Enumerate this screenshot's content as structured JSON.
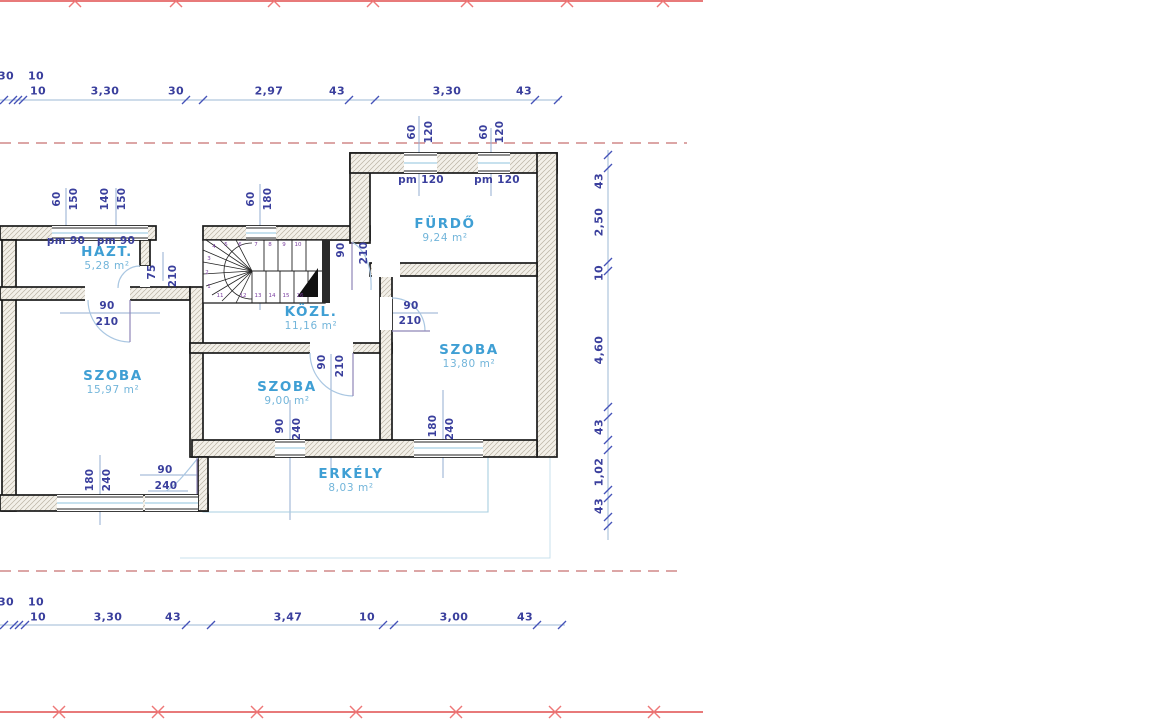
{
  "plan": {
    "rooms": [
      {
        "name": "HÁZT.",
        "area": "5,28 m²",
        "x": 107,
        "y": 252
      },
      {
        "name": "FÜRDŐ",
        "area": "9,24 m²",
        "x": 445,
        "y": 224
      },
      {
        "name": "KÖZL.",
        "area": "11,16 m²",
        "x": 311,
        "y": 312
      },
      {
        "name": "SZOBA",
        "area": "15,97 m²",
        "x": 113,
        "y": 376
      },
      {
        "name": "SZOBA",
        "area": "9,00 m²",
        "x": 287,
        "y": 387
      },
      {
        "name": "SZOBA",
        "area": "13,80 m²",
        "x": 469,
        "y": 350
      },
      {
        "name": "ERKÉLY",
        "area": "8,03 m²",
        "x": 351,
        "y": 474
      }
    ],
    "dim_rows": {
      "top_stacked": [
        {
          "t": "30",
          "x": 6,
          "y": 76
        },
        {
          "t": "10",
          "x": 36,
          "y": 76
        }
      ],
      "top": [
        {
          "t": "10",
          "x": 38,
          "y": 91
        },
        {
          "t": "3,30",
          "x": 105,
          "y": 91
        },
        {
          "t": "30",
          "x": 176,
          "y": 91
        },
        {
          "t": "2,97",
          "x": 269,
          "y": 91
        },
        {
          "t": "43",
          "x": 337,
          "y": 91
        },
        {
          "t": "3,30",
          "x": 447,
          "y": 91
        },
        {
          "t": "43",
          "x": 524,
          "y": 91
        }
      ],
      "bottom_stacked": [
        {
          "t": "30",
          "x": 6,
          "y": 602
        },
        {
          "t": "10",
          "x": 36,
          "y": 602
        }
      ],
      "bottom": [
        {
          "t": "10",
          "x": 38,
          "y": 617
        },
        {
          "t": "3,30",
          "x": 108,
          "y": 617
        },
        {
          "t": "43",
          "x": 173,
          "y": 617
        },
        {
          "t": "3,47",
          "x": 288,
          "y": 617
        },
        {
          "t": "10",
          "x": 367,
          "y": 617
        },
        {
          "t": "3,00",
          "x": 454,
          "y": 617
        },
        {
          "t": "43",
          "x": 525,
          "y": 617
        }
      ],
      "right": [
        {
          "t": "43",
          "x": 599,
          "y": 181
        },
        {
          "t": "2,50",
          "x": 599,
          "y": 222
        },
        {
          "t": "10",
          "x": 599,
          "y": 273
        },
        {
          "t": "4,60",
          "x": 599,
          "y": 350
        },
        {
          "t": "43",
          "x": 599,
          "y": 427
        },
        {
          "t": "1,02",
          "x": 599,
          "y": 472
        },
        {
          "t": "43",
          "x": 599,
          "y": 506
        }
      ]
    },
    "detail_h": [
      {
        "t": "pm 90",
        "x": 66,
        "y": 241
      },
      {
        "t": "pm 90",
        "x": 116,
        "y": 241
      },
      {
        "t": "pm 120",
        "x": 421,
        "y": 180
      },
      {
        "t": "pm 120",
        "x": 497,
        "y": 180
      },
      {
        "t": "90",
        "x": 107,
        "y": 306
      },
      {
        "t": "210",
        "x": 107,
        "y": 322
      },
      {
        "t": "90",
        "x": 411,
        "y": 306
      },
      {
        "t": "210",
        "x": 410,
        "y": 321
      },
      {
        "t": "90",
        "x": 165,
        "y": 470
      },
      {
        "t": "240",
        "x": 166,
        "y": 486
      }
    ],
    "detail_v": [
      {
        "t": "60",
        "x": 57,
        "y": 199
      },
      {
        "t": "150",
        "x": 74,
        "y": 199
      },
      {
        "t": "140",
        "x": 105,
        "y": 199
      },
      {
        "t": "150",
        "x": 122,
        "y": 199
      },
      {
        "t": "60",
        "x": 251,
        "y": 199
      },
      {
        "t": "180",
        "x": 268,
        "y": 199
      },
      {
        "t": "60",
        "x": 412,
        "y": 132
      },
      {
        "t": "120",
        "x": 429,
        "y": 132
      },
      {
        "t": "60",
        "x": 484,
        "y": 132
      },
      {
        "t": "120",
        "x": 500,
        "y": 132
      },
      {
        "t": "75",
        "x": 152,
        "y": 272
      },
      {
        "t": "210",
        "x": 173,
        "y": 276
      },
      {
        "t": "90",
        "x": 341,
        "y": 250
      },
      {
        "t": "210",
        "x": 364,
        "y": 253
      },
      {
        "t": "90",
        "x": 322,
        "y": 362
      },
      {
        "t": "210",
        "x": 340,
        "y": 366
      },
      {
        "t": "90",
        "x": 280,
        "y": 426
      },
      {
        "t": "240",
        "x": 297,
        "y": 429
      },
      {
        "t": "180",
        "x": 90,
        "y": 480
      },
      {
        "t": "240",
        "x": 107,
        "y": 480
      },
      {
        "t": "180",
        "x": 433,
        "y": 426
      },
      {
        "t": "240",
        "x": 450,
        "y": 429
      }
    ],
    "stairs": {
      "numbers": [
        {
          "t": "1",
          "x": 209,
          "y": 287
        },
        {
          "t": "2",
          "x": 207,
          "y": 273
        },
        {
          "t": "3",
          "x": 209,
          "y": 259
        },
        {
          "t": "4",
          "x": 214,
          "y": 247
        },
        {
          "t": "5",
          "x": 226,
          "y": 245
        },
        {
          "t": "6",
          "x": 240,
          "y": 245
        },
        {
          "t": "7",
          "x": 256,
          "y": 245
        },
        {
          "t": "8",
          "x": 270,
          "y": 245
        },
        {
          "t": "9",
          "x": 284,
          "y": 245
        },
        {
          "t": "10",
          "x": 298,
          "y": 245
        },
        {
          "t": "11",
          "x": 220,
          "y": 296
        },
        {
          "t": "12",
          "x": 243,
          "y": 296
        },
        {
          "t": "13",
          "x": 258,
          "y": 296
        },
        {
          "t": "14",
          "x": 272,
          "y": 296
        },
        {
          "t": "15",
          "x": 286,
          "y": 296
        },
        {
          "t": "16",
          "x": 300,
          "y": 296
        }
      ]
    },
    "section_marks": {
      "top_x": [
        75,
        176,
        274,
        373,
        467,
        567,
        663
      ],
      "top_y": 1,
      "bottom_x": [
        59,
        158,
        257,
        356,
        456,
        555,
        654
      ],
      "bottom_y": 712
    },
    "colors": {
      "dim_text": "#3a3f9d",
      "room_name": "#3f9fd4",
      "room_area": "#72b5da",
      "dim_line": "#9db8d6",
      "tick": "#4553b8",
      "door_arc": "#aac7e2",
      "red_line": "#e04f4f",
      "red_dash": "#c87070",
      "stair_number": "#7b3fa0"
    }
  }
}
